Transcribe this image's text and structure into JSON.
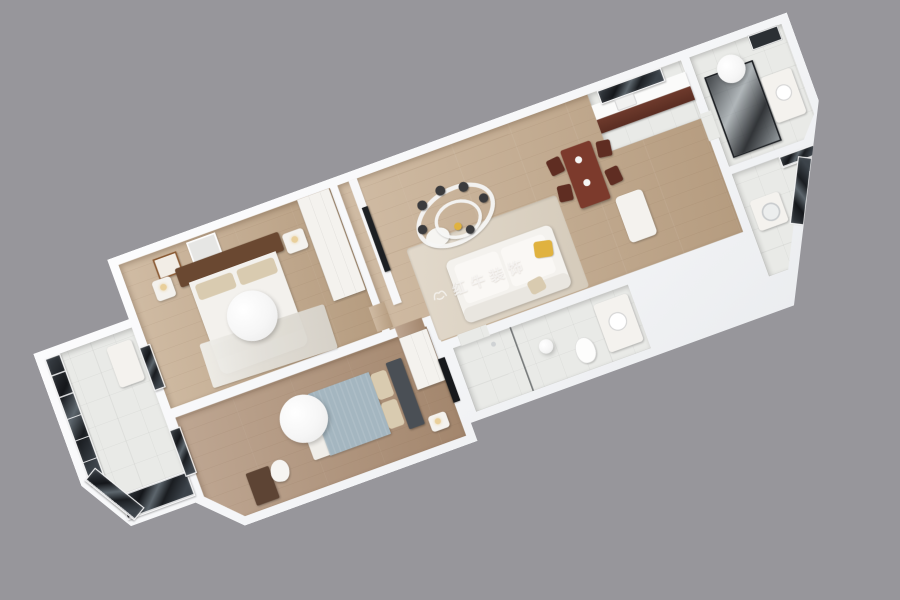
{
  "watermark": {
    "text": "红牛装饰"
  },
  "palette": {
    "bg": "#97969b",
    "wall": "#f7f7f8",
    "wood-light": "#c6ad90",
    "wood-mid": "#bda385",
    "wood-dark": "#b0937a",
    "tile": "#e9eae7",
    "glass-dark": "#1c2024",
    "frame-white": "#f5f5f6",
    "sofa-white": "#f4f2ee",
    "pillow-yellow": "#e0b23f",
    "blanket-blue": "#a4b6c0",
    "pillow-beige": "#d9cbb0",
    "headboard-brown": "#6a4831",
    "headboard-gray": "#4a4f55",
    "dining-wood": "#7c3a2c",
    "watermark": "rgba(255,255,255,0.65)"
  },
  "scene": {
    "type": "3d-apartment-floorplan-render",
    "view": "axonometric top-down, rotated about -20 degrees",
    "rooms": [
      {
        "name": "balcony",
        "features": [
          "dark-framed floor-to-ceiling glazing",
          "ac-unit"
        ]
      },
      {
        "name": "master-bedroom",
        "features": [
          "double-bed",
          "brown-wood-headboard",
          "two-nightstands",
          "wall-art-frames",
          "white-wardrobe",
          "round-ceiling-lamp",
          "marble-rug"
        ]
      },
      {
        "name": "second-bedroom",
        "features": [
          "double-bed",
          "blue-gray-blanket",
          "gray-headboard",
          "desk",
          "white-chair",
          "white-wardrobe",
          "wall-tv",
          "round-ceiling-lamp"
        ]
      },
      {
        "name": "living-room",
        "features": [
          "white-l-sofa",
          "yellow-accent-pillow",
          "beige-area-rug",
          "tv-feature-wall",
          "ring-chandelier-with-dark-globes",
          "pouf"
        ]
      },
      {
        "name": "dining-area",
        "features": [
          "dark-redwood-table",
          "four-dark-chairs",
          "white-fridge-cabinet"
        ]
      },
      {
        "name": "kitchen",
        "features": [
          "white-countertop",
          "dark-brown-lower-cabinets",
          "dark-window",
          "sink"
        ]
      },
      {
        "name": "bathroom-top",
        "features": [
          "black-framed-glass-shower",
          "white-vanity",
          "dark-mirror",
          "round-ceiling-light"
        ]
      },
      {
        "name": "bathroom-bottom",
        "features": [
          "white-vanity",
          "round-sink",
          "toilet",
          "glass-partition",
          "ceiling-light"
        ]
      },
      {
        "name": "utility-laundry",
        "features": [
          "washing-machine",
          "dark-framed-windows"
        ]
      }
    ]
  }
}
